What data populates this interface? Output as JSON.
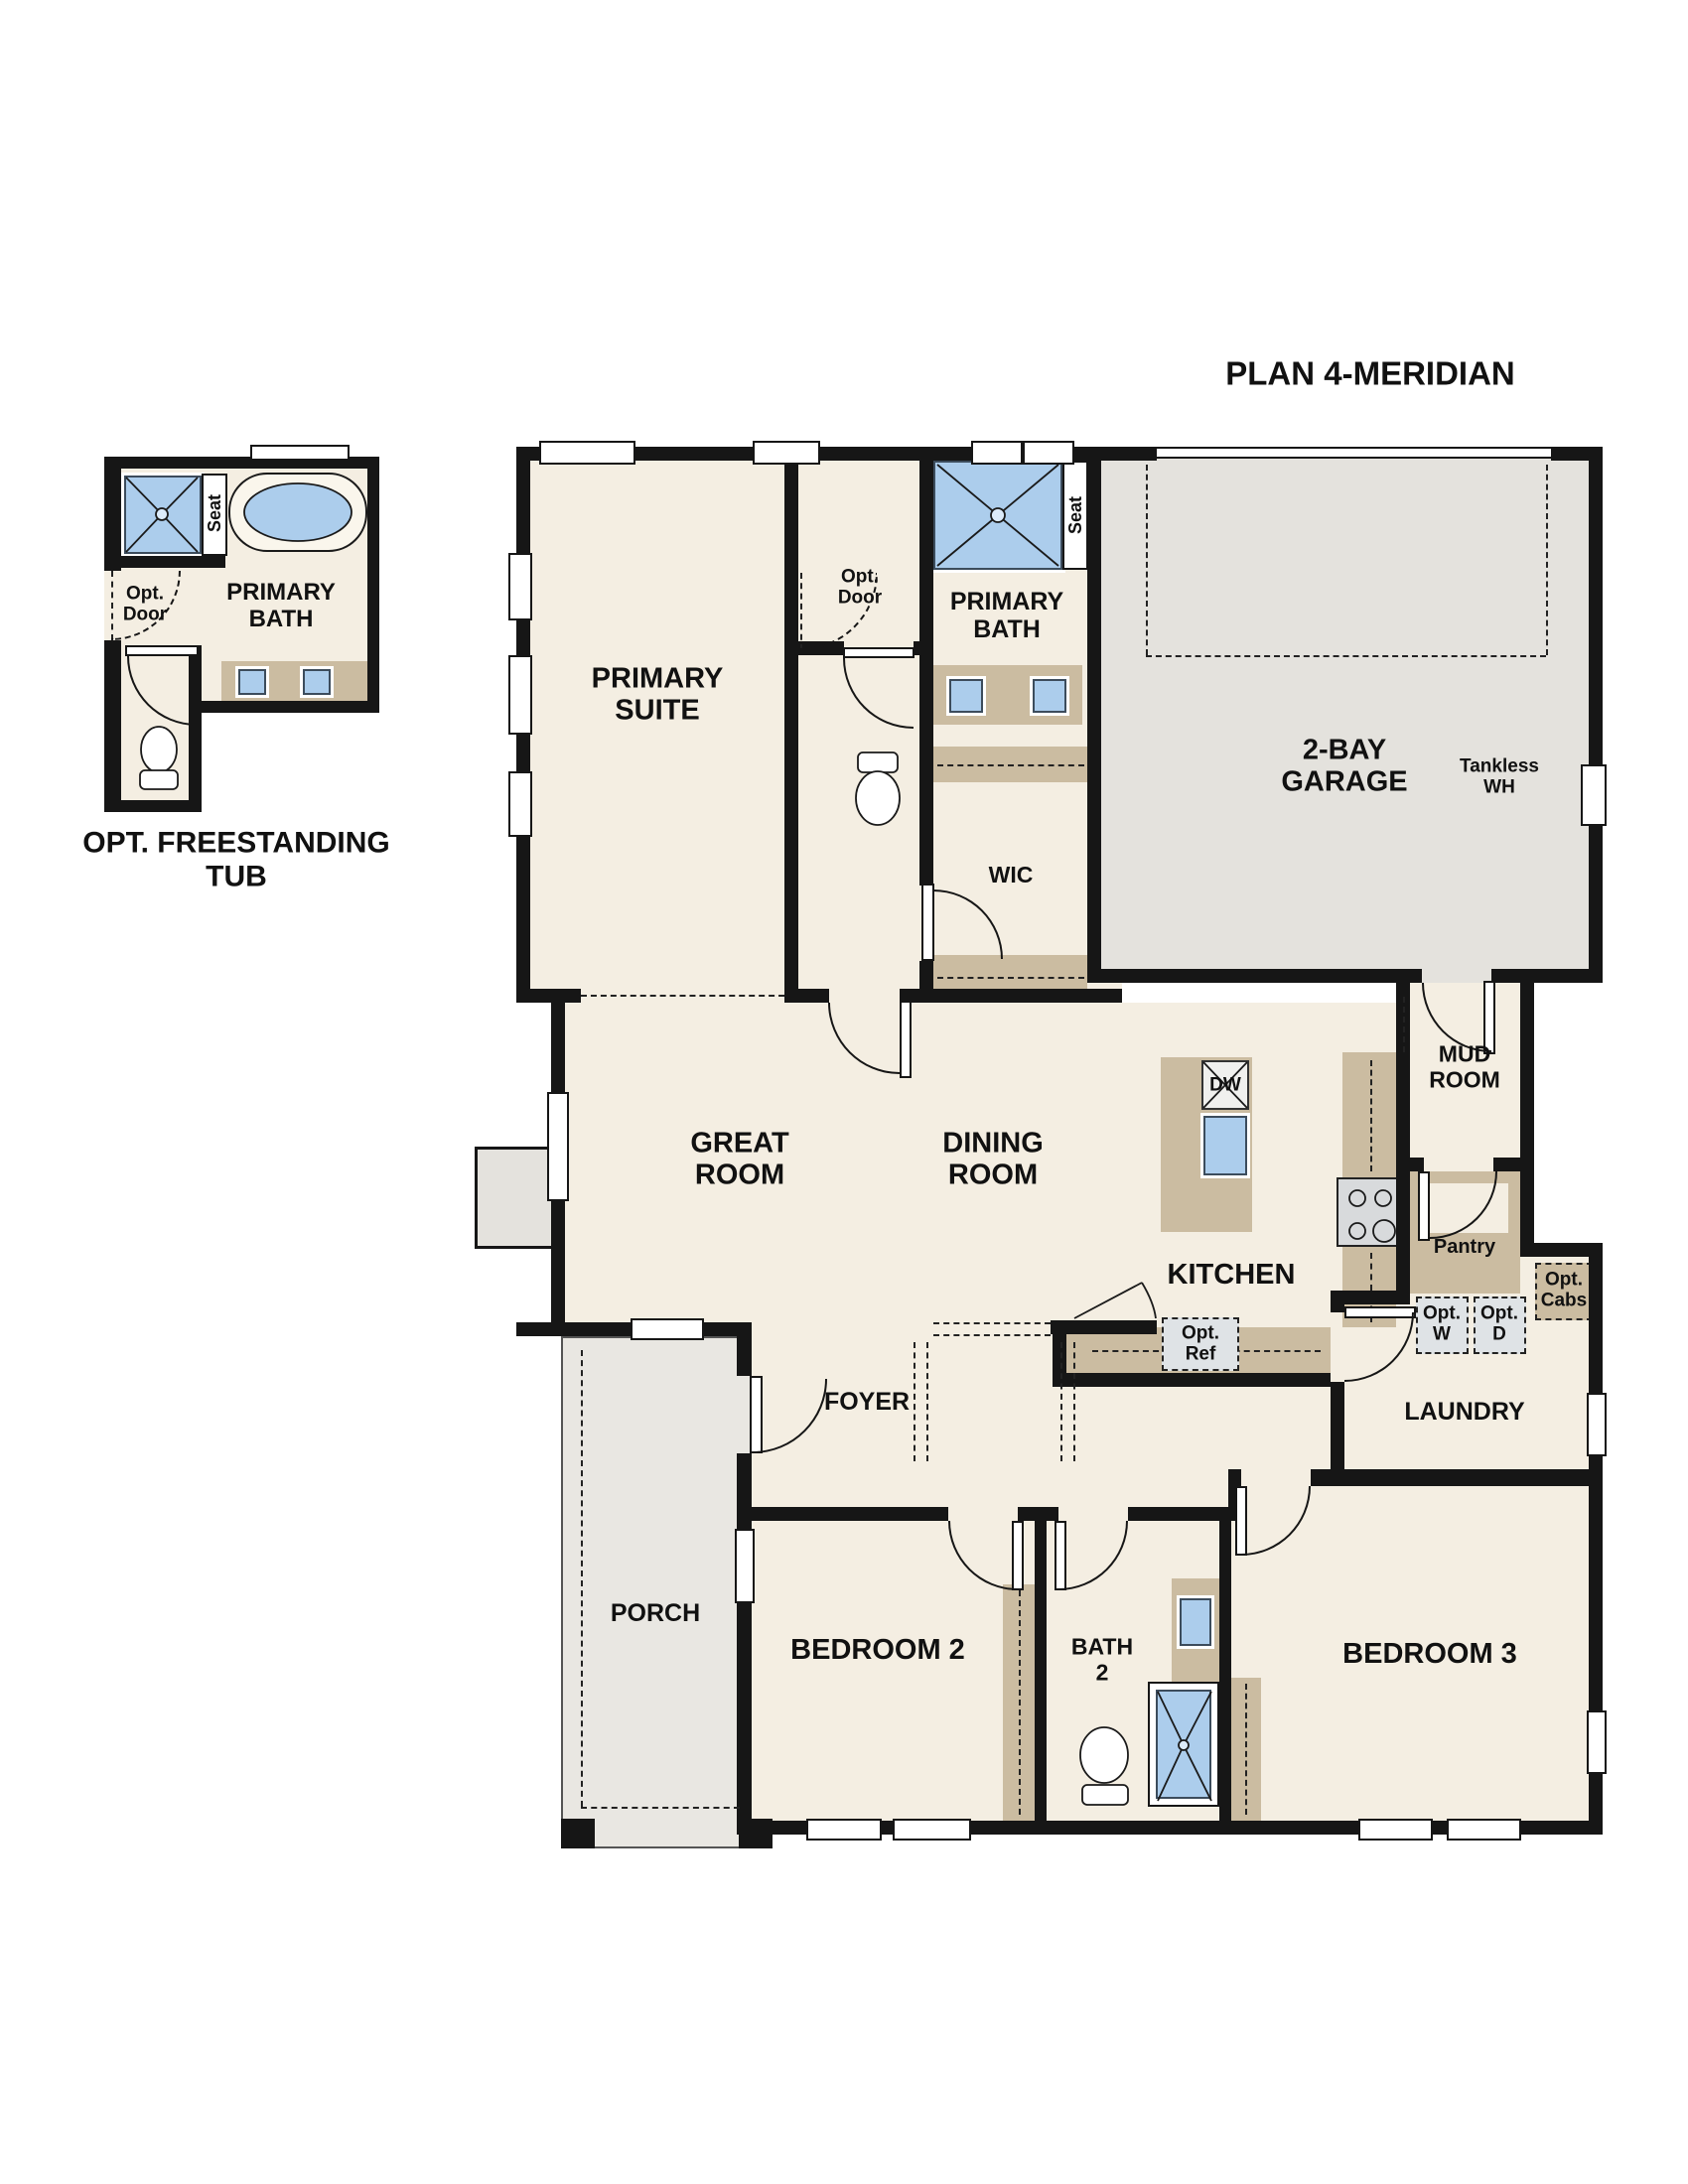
{
  "title": "PLAN 4-MERIDIAN",
  "colors": {
    "wall": "#161616",
    "floor": "#f4eee2",
    "garage": "#e4e2dd",
    "porch": "#e9e7e2",
    "cabinet": "#cbbca1",
    "fixture": "#accdec",
    "optbox": "#dfe3e6",
    "stove": "#d8dadc"
  },
  "inset": {
    "caption": "OPT. FREESTANDING\nTUB",
    "labels": {
      "primary_bath": "PRIMARY\nBATH",
      "seat": "Seat",
      "opt_door": "Opt.\nDoor"
    }
  },
  "rooms": {
    "primary_suite": "PRIMARY\nSUITE",
    "primary_bath": "PRIMARY\nBATH",
    "wic": "WIC",
    "garage": "2-BAY\nGARAGE",
    "great_room": "GREAT\nROOM",
    "dining_room": "DINING\nROOM",
    "kitchen": "KITCHEN",
    "mud_room": "MUD\nROOM",
    "pantry": "Pantry",
    "laundry": "LAUNDRY",
    "foyer": "FOYER",
    "porch": "PORCH",
    "bedroom_2": "BEDROOM 2",
    "bath_2": "BATH\n2",
    "bedroom_3": "BEDROOM 3"
  },
  "annotations": {
    "seat": "Seat",
    "opt_door": "Opt.\nDoor",
    "tankless_wh": "Tankless\nWH",
    "dw": "DW",
    "opt_ref": "Opt.\nRef",
    "opt_w": "Opt.\nW",
    "opt_d": "Opt.\nD",
    "opt_cabs": "Opt.\nCabs"
  }
}
